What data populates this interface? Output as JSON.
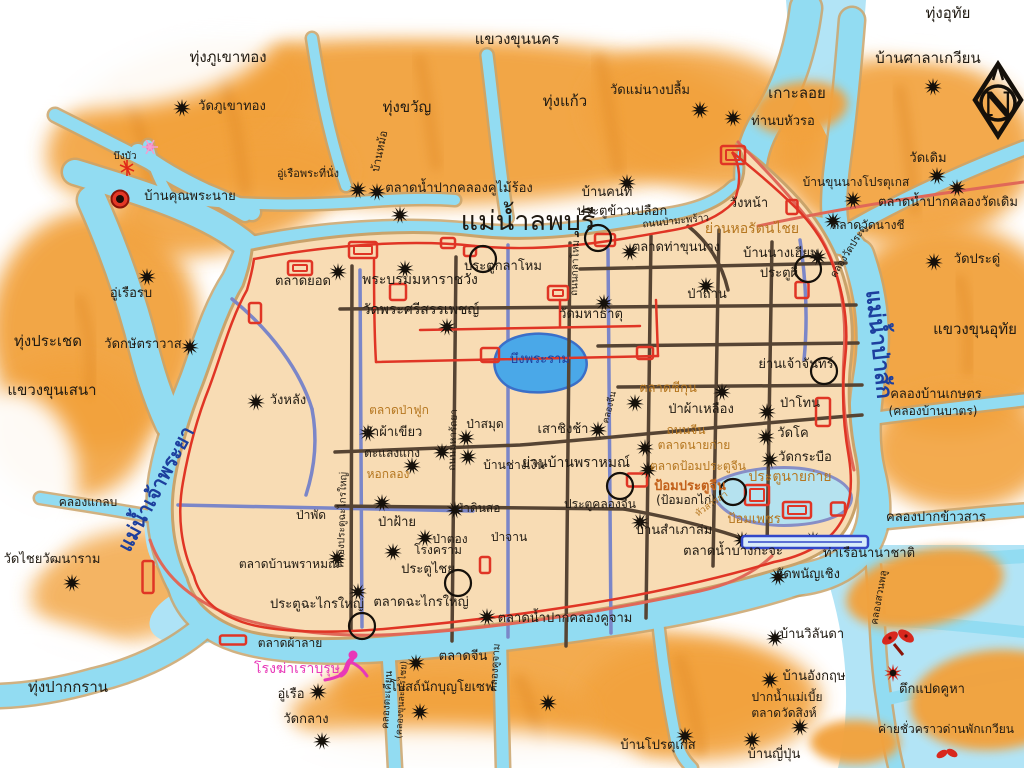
{
  "map_title": "แผนที่กรุงศรีอยุธยา",
  "compass": {
    "letter": "N"
  },
  "palette": {
    "field": "#f2a23d",
    "field_dark": "#e08a28",
    "water": "#92dcf2",
    "water_deep": "#aee3f6",
    "island": "#f8dcb4",
    "bank": "#c9a36b",
    "road": "#564433",
    "canal": "#7b86c8",
    "wall": "#e03525",
    "salmon": "#e06858",
    "ink": "#201a12",
    "market": "#b5761f",
    "river_name": "#1d3f9e",
    "magenta": "#e838b8",
    "fort_text": "#c2601a",
    "pond": "#4aa8e8"
  },
  "labels": [
    {
      "t": "ทุ่งอุทัย",
      "x": 948,
      "y": 18,
      "s": 15
    },
    {
      "t": "บ้านศาลาเกวียน",
      "x": 928,
      "y": 63,
      "s": 15
    },
    {
      "t": "แขวงขุนนคร",
      "x": 517,
      "y": 44,
      "s": 15
    },
    {
      "t": "ทุ่งภูเขาทอง",
      "x": 228,
      "y": 62,
      "s": 15
    },
    {
      "t": "วัดภูเขาทอง",
      "x": 232,
      "y": 110
    },
    {
      "t": "ทุ่งขวัญ",
      "x": 407,
      "y": 112,
      "s": 15
    },
    {
      "t": "ทุ่งแก้ว",
      "x": 565,
      "y": 106,
      "s": 15
    },
    {
      "t": "วัดแม่นางปลื้ม",
      "x": 650,
      "y": 94
    },
    {
      "t": "เกาะลอย",
      "x": 797,
      "y": 98,
      "s": 15
    },
    {
      "t": "ท่านบหัวรอ",
      "x": 783,
      "y": 125
    },
    {
      "t": "วัดเดิม",
      "x": 928,
      "y": 162
    },
    {
      "t": "บึงบัว",
      "x": 125,
      "y": 159,
      "s": 10
    },
    {
      "t": "บ้านคุณพระนาย",
      "x": 190,
      "y": 200
    },
    {
      "t": "อู่เรือพระที่นั่ง",
      "x": 308,
      "y": 177,
      "s": 11
    },
    {
      "t": "บ้านหม้อ",
      "x": 383,
      "y": 152,
      "s": 11,
      "r": -78
    },
    {
      "t": "ตลาดน้ำปากคลองคูไม้ร้อง",
      "x": 459,
      "y": 192
    },
    {
      "t": "แม่น้ำลพบุรี",
      "x": 528,
      "y": 230,
      "s": 27
    },
    {
      "t": "บ้านคนที",
      "x": 607,
      "y": 196
    },
    {
      "t": "ประตูข้าวเปลือก",
      "x": 622,
      "y": 215
    },
    {
      "t": "ถนนป่ามะพร้าว",
      "x": 676,
      "y": 224,
      "s": 10,
      "r": -6
    },
    {
      "t": "บ้านขุนนางโปรตุเกส",
      "x": 856,
      "y": 186,
      "s": 12
    },
    {
      "t": "ตลาดน้ำปากคลองวัดเดิม",
      "x": 948,
      "y": 206
    },
    {
      "t": "ตลาดวัดนางชี",
      "x": 868,
      "y": 229,
      "s": 12
    },
    {
      "t": "คลองวัดประดู่",
      "x": 851,
      "y": 253,
      "s": 10,
      "r": -58
    },
    {
      "t": "วัดประดู่",
      "x": 977,
      "y": 263
    },
    {
      "t": "วังหน้า",
      "x": 749,
      "y": 207
    },
    {
      "t": "ย่านหอรัตนไชย",
      "x": 752,
      "y": 233,
      "s": 14,
      "c": "o"
    },
    {
      "t": "ตลาดท่าขุนนาง",
      "x": 676,
      "y": 251
    },
    {
      "t": "บ้านนางเฮียน",
      "x": 781,
      "y": 257
    },
    {
      "t": "ประตูผี",
      "x": 779,
      "y": 277
    },
    {
      "t": "ป่าถ่าน",
      "x": 707,
      "y": 298
    },
    {
      "t": "ย่านเจ้าจันทร์",
      "x": 796,
      "y": 368
    },
    {
      "t": "แม่น้ำป่าสัก",
      "x": 872,
      "y": 345,
      "s": 22,
      "c": "b",
      "r": 84,
      "b": 1
    },
    {
      "t": "แขวงขุนอุทัย",
      "x": 975,
      "y": 334,
      "s": 15
    },
    {
      "t": "คลองบ้านเกษตร",
      "x": 936,
      "y": 398
    },
    {
      "t": "(คลองบ้านบาตร)",
      "x": 933,
      "y": 415,
      "s": 12
    },
    {
      "t": "คลองปากข้าวสาร",
      "x": 936,
      "y": 521
    },
    {
      "t": "ตลาดยอด",
      "x": 303,
      "y": 285
    },
    {
      "t": "พระบรมมหาราชวัง",
      "x": 420,
      "y": 284,
      "s": 14
    },
    {
      "t": "ประตูกลาโหม",
      "x": 503,
      "y": 270
    },
    {
      "t": "ถนนกลาโหม",
      "x": 578,
      "y": 268,
      "s": 10,
      "r": -88
    },
    {
      "t": "วัดพระศรีสรรเพชญ์",
      "x": 421,
      "y": 314,
      "s": 14
    },
    {
      "t": "วัดมหาธาตุ",
      "x": 591,
      "y": 318
    },
    {
      "t": "บึงพระราม",
      "x": 540,
      "y": 363,
      "c": "b"
    },
    {
      "t": "วังหลัง",
      "x": 288,
      "y": 404
    },
    {
      "t": "ทุ่งประเชด",
      "x": 48,
      "y": 346,
      "s": 15
    },
    {
      "t": "อู่เรือรบ",
      "x": 131,
      "y": 297
    },
    {
      "t": "วัดกษัตราวาส",
      "x": 143,
      "y": 348
    },
    {
      "t": "แขวงขุนเสนา",
      "x": 52,
      "y": 395,
      "s": 15
    },
    {
      "t": "แม่น้ำเจ้าพระยา",
      "x": 162,
      "y": 492,
      "s": 20,
      "c": "b",
      "r": -62,
      "b": 1
    },
    {
      "t": "คลองแกลบ",
      "x": 88,
      "y": 506,
      "s": 12
    },
    {
      "t": "วัดไชยวัฒนาราม",
      "x": 52,
      "y": 563
    },
    {
      "t": "ทุ่งปากกราน",
      "x": 68,
      "y": 692,
      "s": 15
    },
    {
      "t": "ตลาดป่าฟูก",
      "x": 399,
      "y": 414,
      "s": 12,
      "c": "o"
    },
    {
      "t": "ป่าผ้าเขียว",
      "x": 393,
      "y": 436
    },
    {
      "t": "ตะแลงแกง",
      "x": 392,
      "y": 457,
      "s": 12
    },
    {
      "t": "หอกลอง",
      "x": 388,
      "y": 478,
      "s": 12,
      "c": "o"
    },
    {
      "t": "ถนนมหารัถยา",
      "x": 456,
      "y": 440,
      "s": 10,
      "r": -88
    },
    {
      "t": "ป่าสมุด",
      "x": 485,
      "y": 428,
      "s": 12
    },
    {
      "t": "บ้านช่างเงิน",
      "x": 514,
      "y": 469,
      "s": 12
    },
    {
      "t": "ย่านบ้านพราหมณ์",
      "x": 576,
      "y": 467,
      "s": 14
    },
    {
      "t": "เสาชิงช้า",
      "x": 563,
      "y": 433
    },
    {
      "t": "คลองจีน",
      "x": 612,
      "y": 408,
      "s": 9,
      "r": -76
    },
    {
      "t": "ตลาดชีกุน",
      "x": 668,
      "y": 392,
      "c": "o"
    },
    {
      "t": "ป่าผ้าเหลือง",
      "x": 701,
      "y": 413
    },
    {
      "t": "ป่าโทน",
      "x": 800,
      "y": 407
    },
    {
      "t": "ถนนจีน",
      "x": 686,
      "y": 434,
      "s": 12,
      "c": "o"
    },
    {
      "t": "วัดโค",
      "x": 793,
      "y": 437
    },
    {
      "t": "ตลาดนายก่าย",
      "x": 694,
      "y": 449,
      "s": 12,
      "c": "o"
    },
    {
      "t": "วัดกระบือ",
      "x": 805,
      "y": 461
    },
    {
      "t": "ตลาดป้อมประตูจีน",
      "x": 698,
      "y": 470,
      "s": 12,
      "c": "o"
    },
    {
      "t": "ป้อมประตูจีน",
      "x": 690,
      "y": 490,
      "s": 13,
      "c": "rb",
      "b": 1
    },
    {
      "t": "(ป้อมอกไก่)",
      "x": 686,
      "y": 504,
      "s": 12
    },
    {
      "t": "ประตูคลองจีน",
      "x": 600,
      "y": 508,
      "s": 12
    },
    {
      "t": "บ้านสำเภาล่ม",
      "x": 674,
      "y": 534
    },
    {
      "t": "ประตูนายก่าย",
      "x": 790,
      "y": 481,
      "s": 14,
      "c": "o"
    },
    {
      "t": "หัวสารภา",
      "x": 713,
      "y": 506,
      "s": 9,
      "r": -35,
      "c": "o"
    },
    {
      "t": "ป้อมเพชร",
      "x": 754,
      "y": 523,
      "s": 13,
      "c": "o"
    },
    {
      "t": "ตลาดน้ำบางกะจะ",
      "x": 733,
      "y": 555
    },
    {
      "t": "ท่าเรือนานาชาติ",
      "x": 869,
      "y": 557
    },
    {
      "t": "วัดพนัญเชิง",
      "x": 808,
      "y": 578
    },
    {
      "t": "คลองสวนพลู",
      "x": 882,
      "y": 598,
      "s": 10,
      "r": -80
    },
    {
      "t": "บ้านวิลันดา",
      "x": 812,
      "y": 638
    },
    {
      "t": "บ้านอังกฤษ",
      "x": 814,
      "y": 680
    },
    {
      "t": "ปากน้ำแม่เบี้ย",
      "x": 787,
      "y": 701,
      "s": 12
    },
    {
      "t": "ตลาดวัดสิงห์",
      "x": 784,
      "y": 717,
      "s": 12
    },
    {
      "t": "บ้านญี่ปุ่น",
      "x": 774,
      "y": 758
    },
    {
      "t": "ตึกแปดคูหา",
      "x": 932,
      "y": 693
    },
    {
      "t": "ค่ายชั่วคราวด่านพักเกวียน",
      "x": 946,
      "y": 733,
      "s": 12
    },
    {
      "t": "ป่าพัด",
      "x": 311,
      "y": 519,
      "s": 12
    },
    {
      "t": "ป่าฝ้าย",
      "x": 397,
      "y": 526
    },
    {
      "t": "ป่าดินสอ",
      "x": 478,
      "y": 512,
      "s": 12
    },
    {
      "t": "ป่าตอง",
      "x": 450,
      "y": 543,
      "s": 12
    },
    {
      "t": "ป่าจาน",
      "x": 509,
      "y": 541,
      "s": 12
    },
    {
      "t": "โรงคราม",
      "x": 438,
      "y": 554,
      "s": 12
    },
    {
      "t": "ประตูไชย",
      "x": 428,
      "y": 573
    },
    {
      "t": "ตลาดบ้านพราหมณ์",
      "x": 289,
      "y": 568,
      "s": 12
    },
    {
      "t": "ประตูฉะไกรใหญ่",
      "x": 317,
      "y": 608
    },
    {
      "t": "ตลาดฉะไกรใหญ่",
      "x": 421,
      "y": 606
    },
    {
      "t": "คลองประตูฉะไกรใหญ่",
      "x": 345,
      "y": 520,
      "s": 10,
      "r": -88
    },
    {
      "t": "ตลาดผ้าลาย",
      "x": 290,
      "y": 647,
      "s": 12
    },
    {
      "t": "โรงฆ่าเราบุรุษ",
      "x": 297,
      "y": 673,
      "s": 14,
      "c": "m"
    },
    {
      "t": "อู่เรือ",
      "x": 291,
      "y": 698
    },
    {
      "t": "วัดกลาง",
      "x": 306,
      "y": 723
    },
    {
      "t": "คลองตะเคียน",
      "x": 390,
      "y": 700,
      "s": 10,
      "r": -86
    },
    {
      "t": "(คลองขุนละครไชย)",
      "x": 404,
      "y": 700,
      "s": 9,
      "r": -86
    },
    {
      "t": "ตลาดจีน",
      "x": 463,
      "y": 660
    },
    {
      "t": "โบสถ์นักบุญโยเซฟ",
      "x": 442,
      "y": 691
    },
    {
      "t": "คลองคูจาม",
      "x": 498,
      "y": 668,
      "s": 10,
      "r": -86
    },
    {
      "t": "ตลาดน้ำปากคลองคูจาม",
      "x": 565,
      "y": 622
    },
    {
      "t": "บ้านโปรตุเกส",
      "x": 658,
      "y": 749
    }
  ],
  "markers": {
    "stars": [
      [
        182,
        108
      ],
      [
        700,
        110
      ],
      [
        933,
        87
      ],
      [
        937,
        176
      ],
      [
        733,
        118
      ],
      [
        627,
        183
      ],
      [
        358,
        190
      ],
      [
        377,
        192
      ],
      [
        400,
        215
      ],
      [
        853,
        200
      ],
      [
        957,
        188
      ],
      [
        833,
        221
      ],
      [
        934,
        262
      ],
      [
        630,
        252
      ],
      [
        818,
        257
      ],
      [
        706,
        286
      ],
      [
        147,
        277
      ],
      [
        190,
        347
      ],
      [
        338,
        272
      ],
      [
        405,
        269
      ],
      [
        447,
        327
      ],
      [
        604,
        303
      ],
      [
        256,
        402
      ],
      [
        368,
        433
      ],
      [
        442,
        452
      ],
      [
        412,
        466
      ],
      [
        466,
        438
      ],
      [
        468,
        457
      ],
      [
        598,
        430
      ],
      [
        635,
        403
      ],
      [
        722,
        392
      ],
      [
        767,
        412
      ],
      [
        766,
        437
      ],
      [
        645,
        448
      ],
      [
        770,
        460
      ],
      [
        648,
        470
      ],
      [
        455,
        510
      ],
      [
        382,
        503
      ],
      [
        337,
        558
      ],
      [
        425,
        538
      ],
      [
        358,
        592
      ],
      [
        393,
        552
      ],
      [
        416,
        663
      ],
      [
        318,
        692
      ],
      [
        322,
        741
      ],
      [
        420,
        712
      ],
      [
        548,
        703
      ],
      [
        487,
        617
      ],
      [
        685,
        736
      ],
      [
        742,
        540
      ],
      [
        813,
        540
      ],
      [
        778,
        577
      ],
      [
        775,
        638
      ],
      [
        770,
        680
      ],
      [
        800,
        727
      ],
      [
        752,
        740
      ],
      [
        72,
        583
      ],
      [
        640,
        522
      ]
    ],
    "circles": [
      [
        598,
        238
      ],
      [
        483,
        259
      ],
      [
        808,
        269
      ],
      [
        824,
        371
      ],
      [
        733,
        492
      ],
      [
        458,
        583
      ],
      [
        362,
        626
      ],
      [
        620,
        486
      ]
    ],
    "forts": [
      [
        363,
        250,
        28,
        16
      ],
      [
        300,
        268,
        24,
        14
      ],
      [
        255,
        313,
        12,
        20
      ],
      [
        398,
        292,
        16,
        16
      ],
      [
        558,
        293,
        20,
        14
      ],
      [
        490,
        355,
        18,
        14
      ],
      [
        645,
        353,
        16,
        12
      ],
      [
        448,
        243,
        14,
        10
      ],
      [
        470,
        251,
        12,
        10
      ],
      [
        605,
        240,
        20,
        12
      ],
      [
        733,
        155,
        24,
        18
      ],
      [
        792,
        207,
        11,
        14
      ],
      [
        802,
        290,
        13,
        16
      ],
      [
        823,
        412,
        14,
        28
      ],
      [
        637,
        480,
        20,
        13
      ],
      [
        757,
        495,
        24,
        20
      ],
      [
        797,
        510,
        28,
        16
      ],
      [
        838,
        509,
        14,
        13
      ],
      [
        485,
        565,
        10,
        16
      ],
      [
        148,
        577,
        11,
        32
      ],
      [
        233,
        640,
        26,
        9
      ]
    ],
    "specials": [
      {
        "type": "village-dot",
        "x": 120,
        "y": 199
      },
      {
        "type": "insect",
        "x": 127,
        "y": 168
      },
      {
        "type": "lotus",
        "x": 150,
        "y": 147
      },
      {
        "type": "figure",
        "x": 347,
        "y": 668
      },
      {
        "type": "moth",
        "x": 898,
        "y": 646
      },
      {
        "type": "camp-star",
        "x": 893,
        "y": 673
      },
      {
        "type": "moth-small",
        "x": 947,
        "y": 757
      },
      {
        "type": "pier",
        "x": 742,
        "y": 536,
        "w": 126,
        "h": 12
      }
    ]
  }
}
